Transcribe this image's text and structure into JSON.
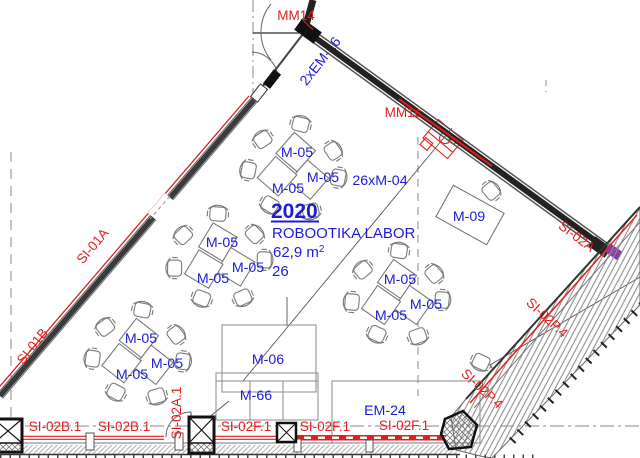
{
  "labels": {
    "room_number": "2020",
    "room_name": "ROBOOTIKA LABOR",
    "room_area": "62,9 m",
    "room_area_sup": "2",
    "room_capacity": "26",
    "chairs_spec": "26xM-04",
    "table": "M-05",
    "desk_m06": "M-06",
    "bench_m66": "M-66",
    "table_m09": "M-09",
    "cabinet_em24": "EM-24",
    "door_mm14": "MM14",
    "fixture_mm1c": "MM1c",
    "wall_em16": "2xEM-16",
    "wall_si01a": "SI-01A",
    "wall_si01b": "SI-01B",
    "wall_si02a": "SI-02A",
    "wall_si02a1": "SI-02A.1",
    "wall_si02b1": "SI-02B.1",
    "wall_si02f1": "SI-02F.1",
    "wall_si02p4": "SI-02P.4"
  },
  "colors": {
    "annotation_blue": "#1C1CD8",
    "wall_label_red": "#E31E1E",
    "wall_dark": "#222222",
    "furniture_gray": "#777777",
    "accent_purple": "#8C35B5"
  }
}
